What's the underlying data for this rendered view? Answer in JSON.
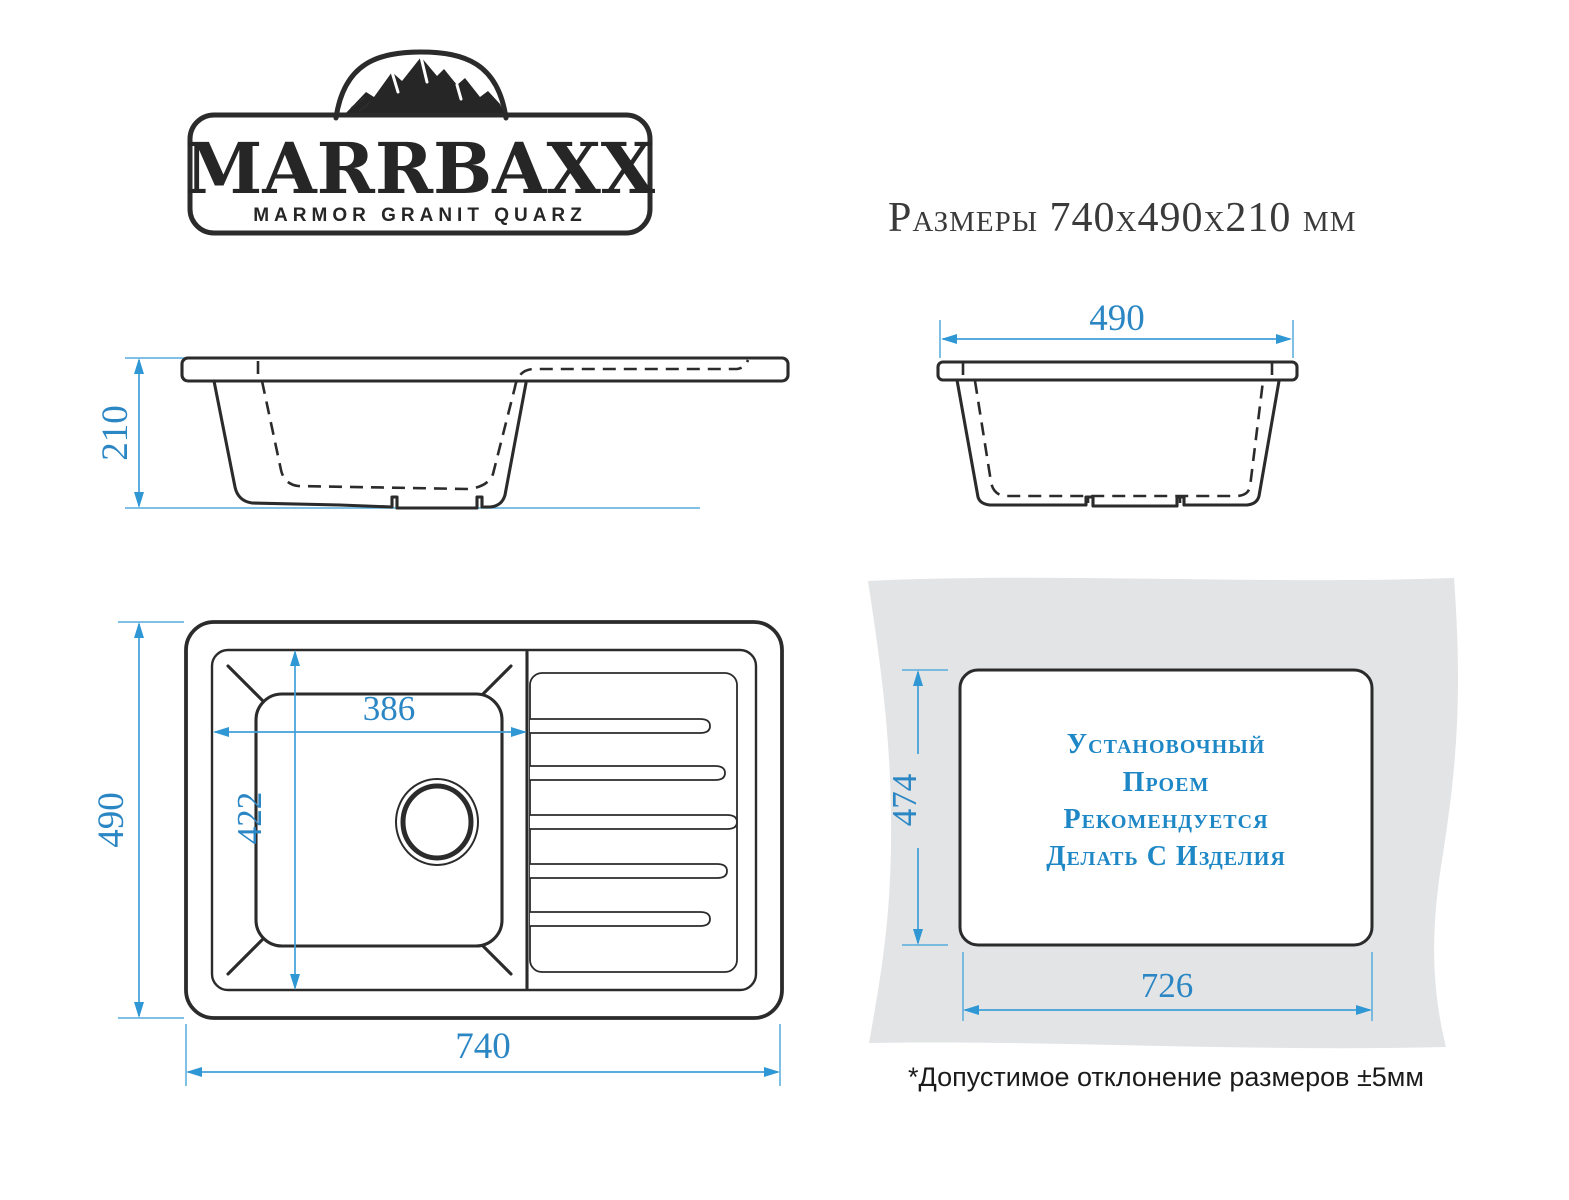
{
  "logo": {
    "brand": "MARRBAXX",
    "tagline": "MARMOR GRANIT QUARZ"
  },
  "title": "Размеры 740x490x210 мм",
  "dimensions": {
    "front_height": "210",
    "end_width": "490",
    "top_length": "740",
    "top_depth": "490",
    "bowl_width": "386",
    "bowl_depth": "422",
    "cutout_height": "474",
    "cutout_width": "726"
  },
  "cutout_note": {
    "line1": "Установочный",
    "line2": "Проем",
    "line3": "Рекомендуется",
    "line4": "Делать С Изделия"
  },
  "footnote": "*Допустимое отклонение размеров ±5мм",
  "colors": {
    "dimension_line_blue": "#3f9fd8",
    "dimension_text_blue": "#2b86c4",
    "cutout_text_blue": "#1e87c6",
    "drawing_black": "#2b2b2b",
    "countertop_gray": "#e3e4e6"
  }
}
